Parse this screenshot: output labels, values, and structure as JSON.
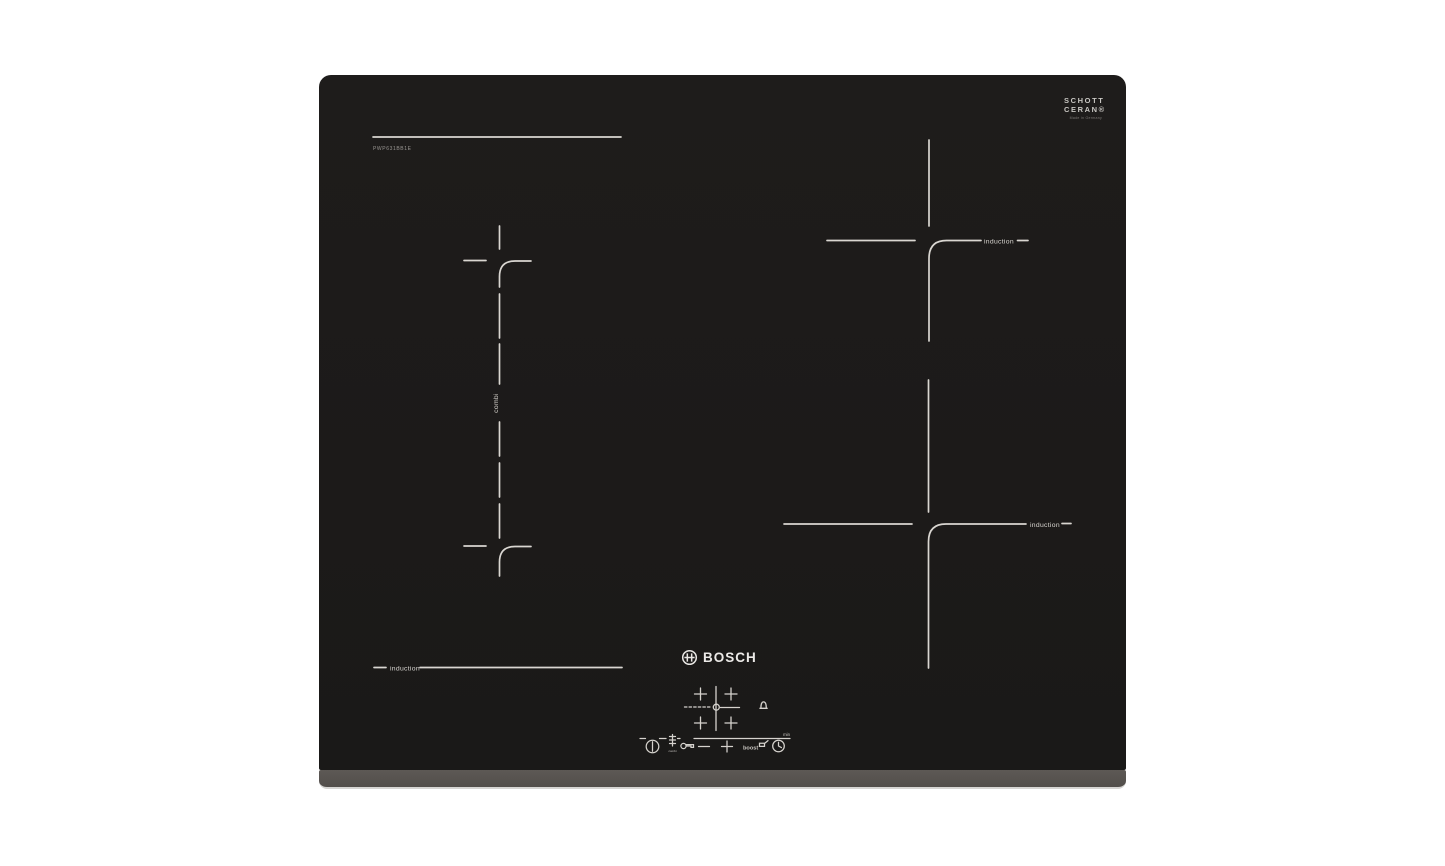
{
  "page": {
    "background": "#ffffff",
    "width": 1445,
    "height": 866
  },
  "hob": {
    "brand_wordmark": "BOSCH",
    "model_number": "PWP631BB1E",
    "glass_brand": {
      "line1": "SCHOTT",
      "line2": "CERAN®",
      "subtext": "Made in Germany"
    },
    "zone_labels": {
      "combi_zone": "combi",
      "back_right_zone": "induction",
      "front_right_zone": "induction",
      "front_left_zone": "induction"
    },
    "control_panel": {
      "boost_key_label": "boost",
      "timer_unit_label": "min",
      "combi_key_label": "combi",
      "icons": {
        "power": "power-icon",
        "combi_key": "combi-zones-icon",
        "child_lock": "key-icon",
        "minus": "minus-icon",
        "plus": "plus-icon",
        "boost_pan": "pan-icon",
        "timer": "clock-icon",
        "zone_selector": "zone-select-cross-icon",
        "timer_alarm": "bell-icon"
      }
    },
    "colors": {
      "glass_black": "#1d1b1a",
      "marking_white": "#d9d6d1",
      "front_bezel_gray": "#57534f"
    }
  }
}
